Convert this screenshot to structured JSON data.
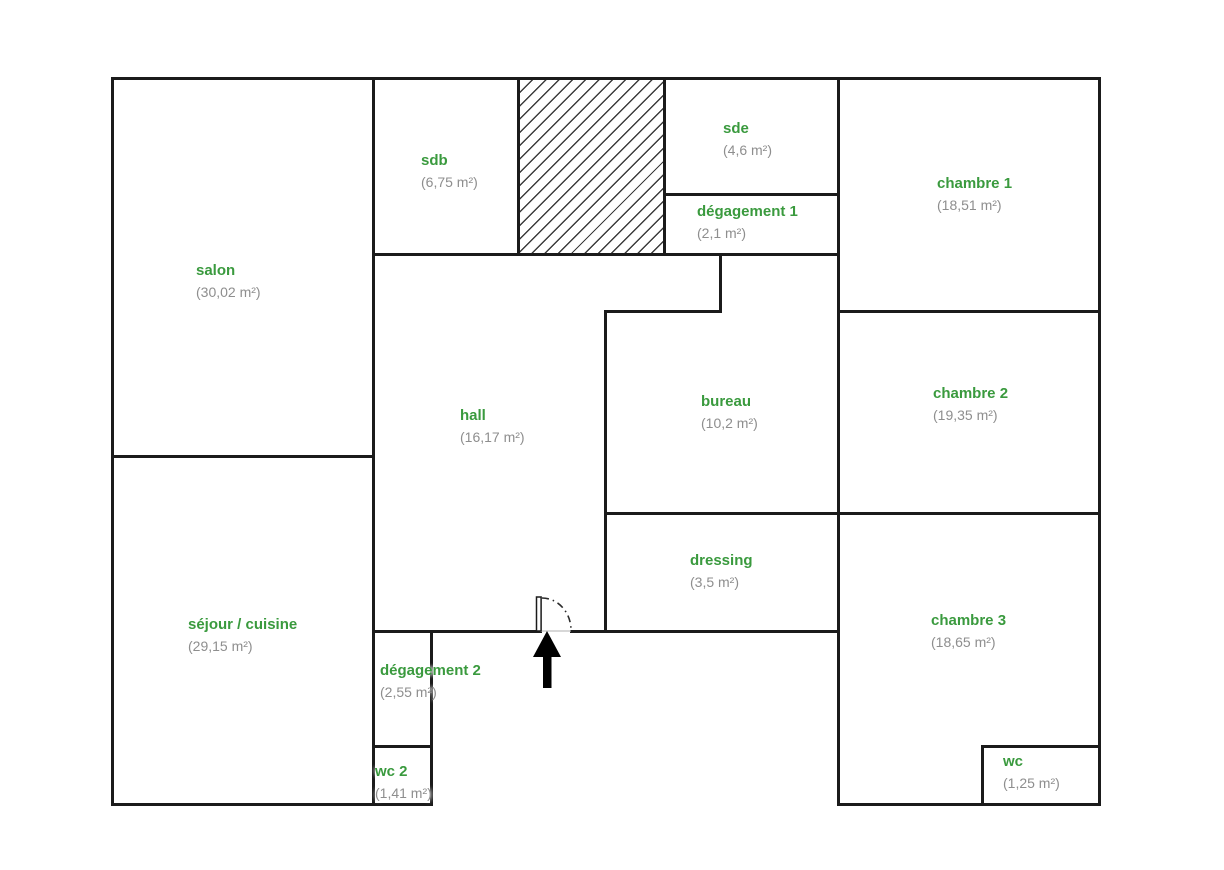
{
  "plan": {
    "type": "floor-plan",
    "background_color": "#ffffff",
    "wall_color": "#1b1b1b",
    "room_name_color": "#3a9a3e",
    "room_area_color": "#8e8e8e",
    "annotations": {
      "entrance_arrow_icon": "up-arrow",
      "door_swing_icon": "quarter-arc-dash-dot",
      "shaft_area": "diagonal-hatch"
    }
  },
  "rooms": [
    {
      "name": "salon",
      "area": "(30,02 m²)"
    },
    {
      "name": "sdb",
      "area": "(6,75 m²)"
    },
    {
      "name": "sde",
      "area": "(4,6 m²)"
    },
    {
      "name": "dégagement 1",
      "area": "(2,1 m²)"
    },
    {
      "name": "chambre 1",
      "area": "(18,51 m²)"
    },
    {
      "name": "hall",
      "area": "(16,17 m²)"
    },
    {
      "name": "bureau",
      "area": "(10,2 m²)"
    },
    {
      "name": "chambre 2",
      "area": "(19,35 m²)"
    },
    {
      "name": "dressing",
      "area": "(3,5 m²)"
    },
    {
      "name": "séjour / cuisine",
      "area": "(29,15 m²)"
    },
    {
      "name": "dégagement 2",
      "area": "(2,55 m²)"
    },
    {
      "name": "chambre 3",
      "area": "(18,65 m²)"
    },
    {
      "name": "wc 2",
      "area": "(1,41 m²)"
    },
    {
      "name": "wc",
      "area": "(1,25 m²)"
    }
  ]
}
